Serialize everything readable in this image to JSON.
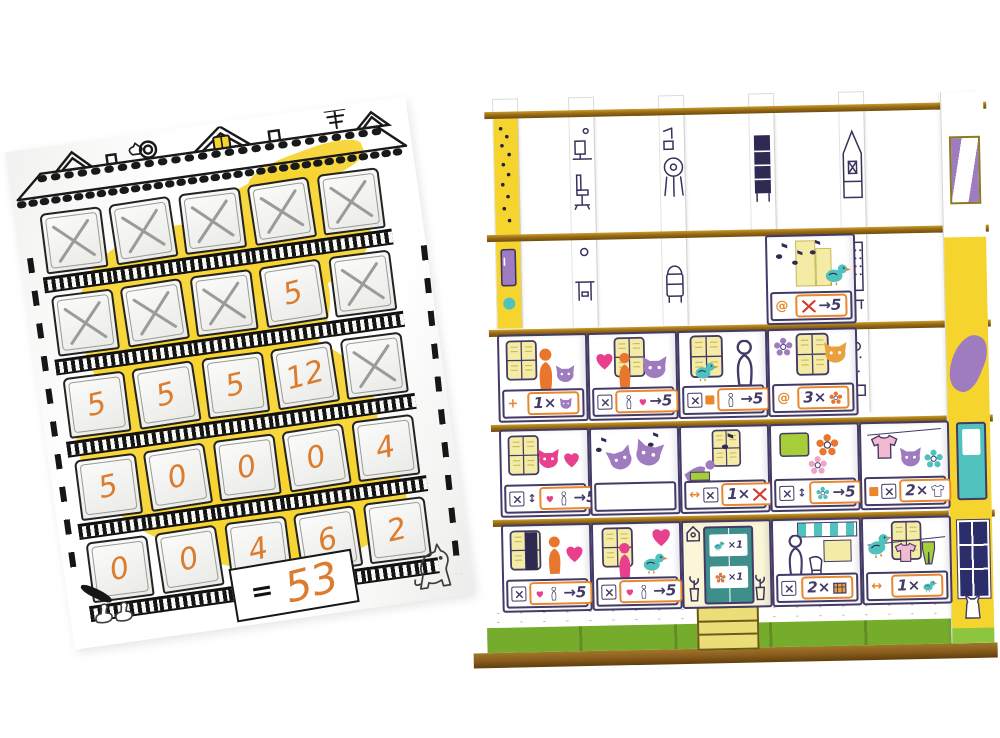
{
  "colors": {
    "yellow": "#F6D42E",
    "grass": "#8CC63E",
    "grass-dark": "#76AC2B",
    "cardboard": "#9A6D15",
    "ink": "#433A66",
    "orange": "#E8872E",
    "hand": "#DB7C2E",
    "purple": "#9F7BC0",
    "pink": "#E8408C",
    "teal": "#4FC2BE",
    "pencil": "#9B9B99",
    "navy": "#2B2E6B"
  },
  "icons": {
    "at": "@",
    "plus": "+",
    "arrows_h": "↔",
    "arrows_v": "↕"
  },
  "scoresheet": {
    "grid": [
      [
        "X",
        "X",
        "X",
        "X",
        "X"
      ],
      [
        "X",
        "X",
        "X",
        "5",
        "X"
      ],
      [
        "5",
        "5",
        "5",
        "12",
        "X"
      ],
      [
        "5",
        "0",
        "0",
        "0",
        "4"
      ],
      [
        "0",
        "0",
        "4",
        "6",
        "2"
      ]
    ],
    "equals_label": "=",
    "total": "53"
  },
  "structure": {
    "upper_box": {
      "scene": "singing-bird-with-music-notes",
      "prefix": "at",
      "subject": "crossed-window",
      "rule": "→5"
    },
    "row3": [
      {
        "scene": "grandma-hugging-cat",
        "prefix": "plus",
        "rule": "1×",
        "icon": "cat"
      },
      {
        "scene": "woman-heart-and-cat",
        "prefix": "x",
        "subject": "heart-person",
        "rule": "→5"
      },
      {
        "scene": "bird-and-cat-lady",
        "prefix": "x,square",
        "subject": "person",
        "rule": "→5"
      },
      {
        "scene": "tiger-cat-painting",
        "prefix": "at",
        "rule": "3×",
        "icon": "flower"
      }
    ],
    "row4": [
      {
        "scene": "cat-in-pink-sweater",
        "prefix": "x,arrows_v",
        "subject": "heart-person",
        "rule": "→5"
      },
      {
        "scene": "cats-jam-session"
      },
      {
        "scene": "lounging-woman-music",
        "prefix": "arrows_h,x",
        "rule": "1×",
        "icon": "crossed-window"
      },
      {
        "scene": "towel-and-flowers",
        "prefix": "x,arrows_v",
        "subject": "flower",
        "rule": "→5"
      },
      {
        "scene": "shirt-and-cat",
        "prefix": "square,x",
        "rule": "2×",
        "icon": "shirt"
      }
    ],
    "row5": [
      {
        "scene": "man-in-love",
        "prefix": "x",
        "subject": "heart-person",
        "rule": "→5"
      },
      {
        "scene": "woman-with-bird",
        "prefix": "x",
        "subject": "heart-person",
        "rule": "→5"
      },
      {
        "scene": "entrance-door",
        "signs": [
          {
            "icon": "bird",
            "text": "×1"
          },
          {
            "icon": "flower",
            "text": "×1"
          }
        ]
      },
      {
        "scene": "grocery-shop-grandma",
        "prefix": "x",
        "rule": "2×",
        "icon": "crate"
      },
      {
        "scene": "bird-hanging-laundry",
        "prefix": "arrows_h",
        "rule": "1×",
        "icon": "bird"
      }
    ]
  }
}
